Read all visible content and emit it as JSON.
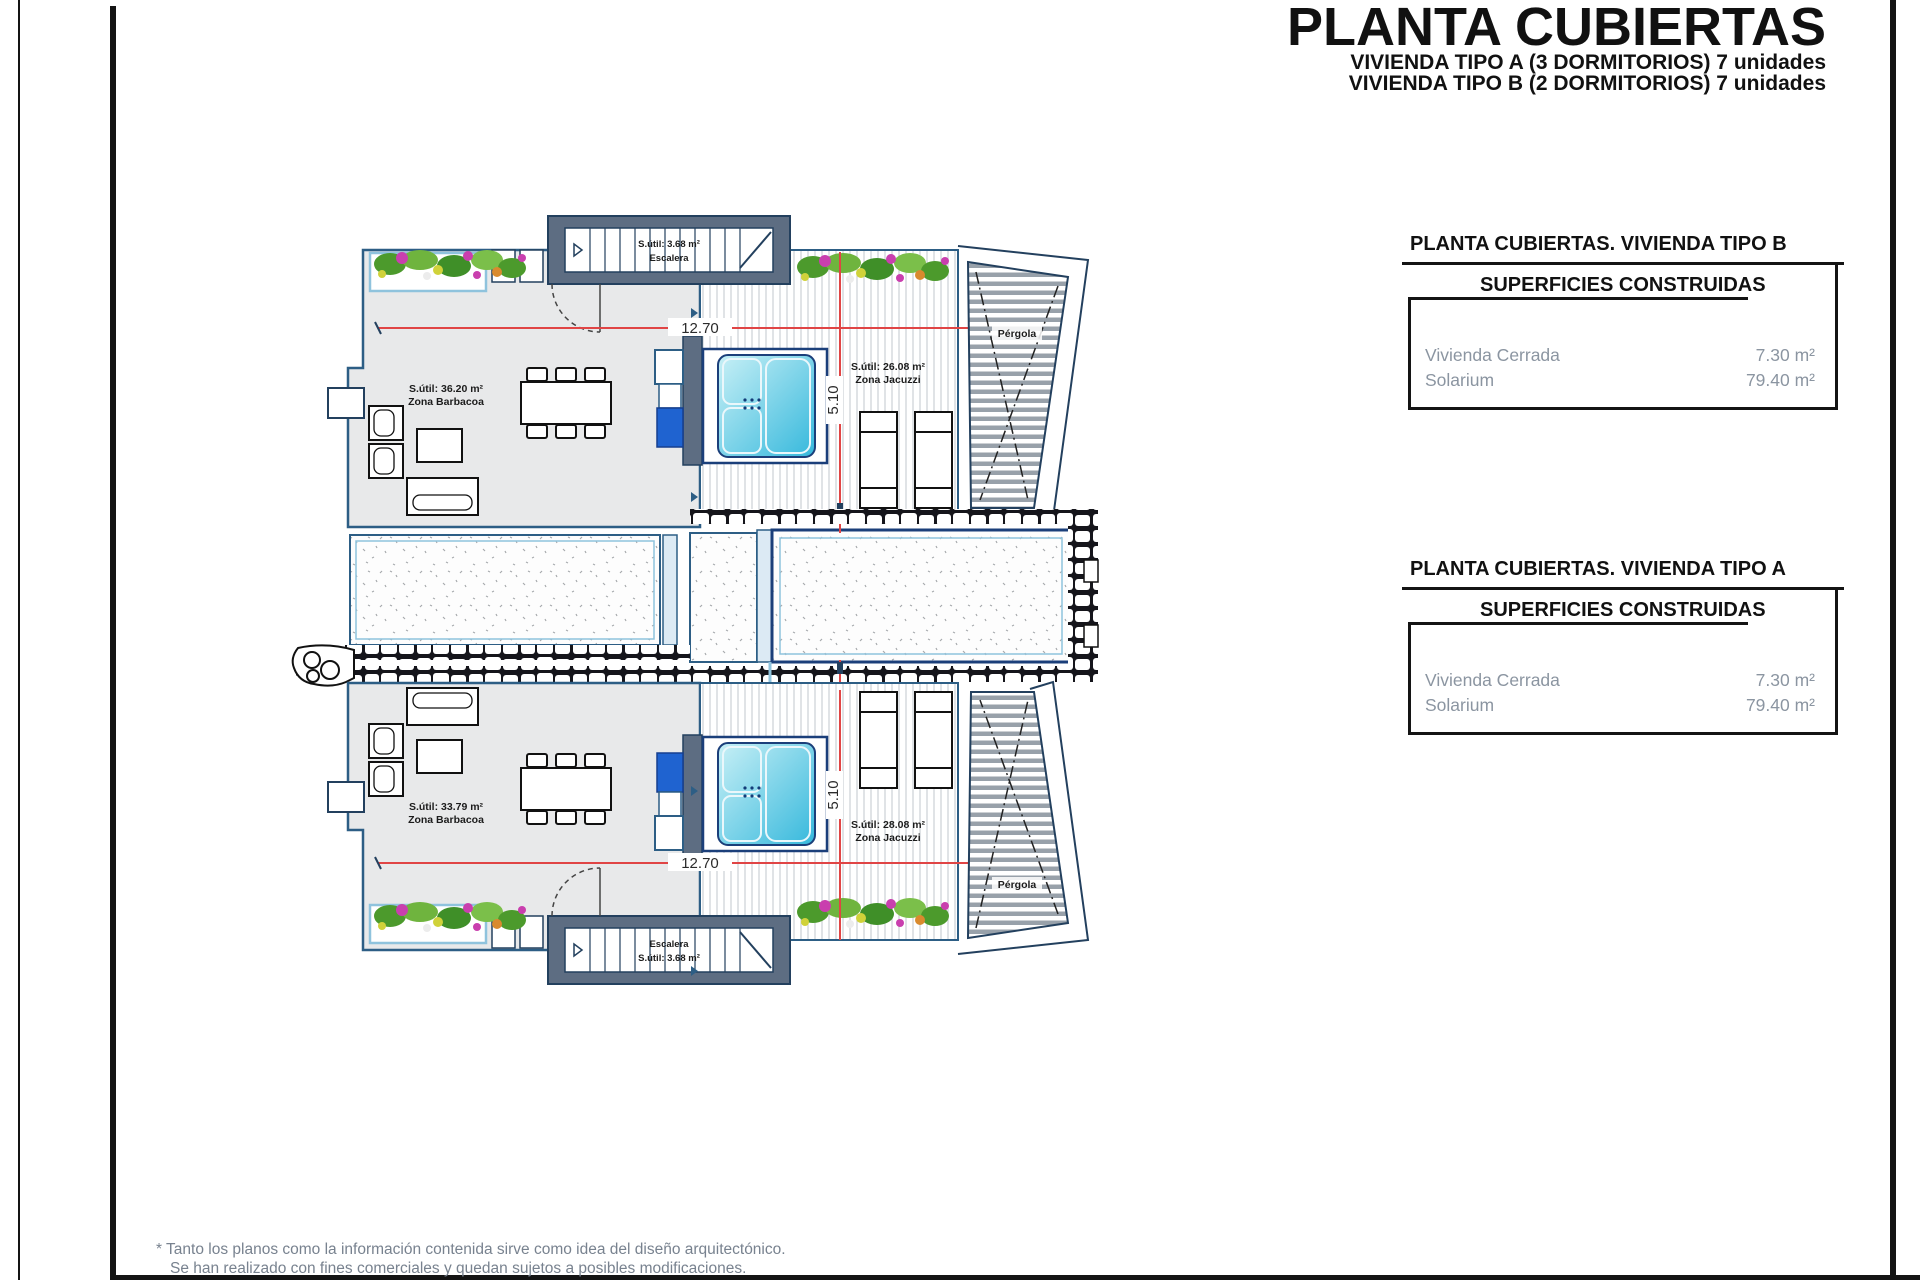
{
  "title": {
    "main": "PLANTA CUBIERTAS",
    "sub1": "VIVIENDA TIPO A (3 DORMITORIOS) 7 unidades",
    "sub2": "VIVIENDA TIPO B (2 DORMITORIOS) 7 unidades"
  },
  "tables": {
    "tipo_b": {
      "title": "PLANTA CUBIERTAS. VIVIENDA TIPO B",
      "box_title": "SUPERFICIES CONSTRUIDAS",
      "rows": [
        {
          "label": "Vivienda Cerrada",
          "value": "7.30 m²"
        },
        {
          "label": "Solarium",
          "value": "79.40 m²"
        }
      ]
    },
    "tipo_a": {
      "title": "PLANTA CUBIERTAS. VIVIENDA TIPO A",
      "box_title": "SUPERFICIES CONSTRUIDAS",
      "rows": [
        {
          "label": "Vivienda Cerrada",
          "value": "7.30 m²"
        },
        {
          "label": "Solarium",
          "value": "79.40 m²"
        }
      ]
    }
  },
  "plan": {
    "dim_width": "12.70",
    "dim_depth": "5.10",
    "stair_area": "S.útil: 3.68 m²",
    "stair_label": "Escalera",
    "pergola_label": "Pérgola",
    "unit_b": {
      "barbecue_area": "S.útil: 36.20 m²",
      "barbecue_label": "Zona Barbacoa",
      "jacuzzi_area": "S.útil: 26.08 m²",
      "jacuzzi_label": "Zona Jacuzzi"
    },
    "unit_a": {
      "barbecue_area": "S.útil: 33.79 m²",
      "barbecue_label": "Zona Barbacoa",
      "jacuzzi_area": "S.útil: 28.08 m²",
      "jacuzzi_label": "Zona Jacuzzi"
    }
  },
  "footer": {
    "line1": "* Tanto los planos como la información contenida sirve como idea del diseño arquitectónico.",
    "line2": "Se han realizado con fines comerciales y quedan sujetos a posibles modificaciones.",
    "colors": {
      "wall": "#5d6d82",
      "line_blue": "#2d5e85",
      "light_blue": "#8fc3dd",
      "floor": "#e8e9ea",
      "dimension_red": "#e04545",
      "jacuzzi_cyan": "#35b8dc",
      "note_gray": "#78828f"
    }
  }
}
